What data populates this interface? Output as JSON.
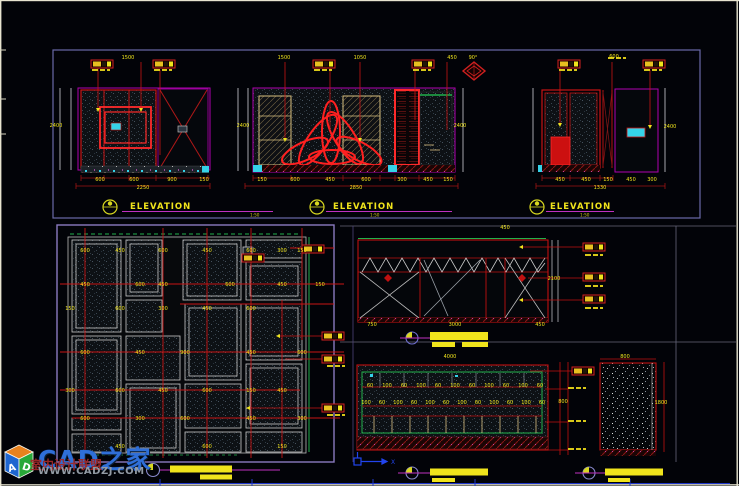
{
  "watermark": {
    "title": "CAD之家",
    "subtitle": "室内设计联盟",
    "url": "WWW.CADZJ.COM",
    "cube_left": "A",
    "cube_right": "D"
  },
  "titles": {
    "elevation": "ELEVATION",
    "scale": "1:50",
    "angle": "90°"
  },
  "colors": {
    "frame_red": "#c81414",
    "bright_red": "#ff2a2a",
    "magenta": "#b000b0",
    "yellow": "#f0e41c",
    "cyan": "#35d2e8",
    "green": "#22b14c",
    "section_border": "#6a6aa8",
    "plan_border": "#8a7ac0",
    "blue": "#2a4fd0"
  },
  "label_boxes": [
    {
      "x": 91,
      "y": 60
    },
    {
      "x": 153,
      "y": 60
    },
    {
      "x": 313,
      "y": 60
    },
    {
      "x": 412,
      "y": 60
    },
    {
      "x": 558,
      "y": 60
    },
    {
      "x": 643,
      "y": 60
    },
    {
      "x": 322,
      "y": 332
    },
    {
      "x": 322,
      "y": 355
    },
    {
      "x": 322,
      "y": 404
    },
    {
      "x": 583,
      "y": 243
    },
    {
      "x": 583,
      "y": 273
    },
    {
      "x": 583,
      "y": 295
    },
    {
      "x": 572,
      "y": 367
    },
    {
      "x": 302,
      "y": 245
    },
    {
      "x": 242,
      "y": 254
    }
  ],
  "dash_rows": [
    {
      "x": 92,
      "y": 69
    },
    {
      "x": 154,
      "y": 69
    },
    {
      "x": 314,
      "y": 69
    },
    {
      "x": 413,
      "y": 69
    },
    {
      "x": 559,
      "y": 69
    },
    {
      "x": 644,
      "y": 69
    },
    {
      "x": 608,
      "y": 57
    },
    {
      "x": 585,
      "y": 254
    },
    {
      "x": 585,
      "y": 285
    },
    {
      "x": 585,
      "y": 307
    },
    {
      "x": 568,
      "y": 387
    },
    {
      "x": 568,
      "y": 420
    },
    {
      "x": 568,
      "y": 448
    },
    {
      "x": 327,
      "y": 365
    },
    {
      "x": 327,
      "y": 414
    }
  ],
  "dim_labels": [
    {
      "x": 56,
      "y": 127,
      "t": "2400"
    },
    {
      "x": 128,
      "y": 59,
      "t": "1500"
    },
    {
      "x": 100,
      "y": 181,
      "t": "600"
    },
    {
      "x": 134,
      "y": 181,
      "t": "600"
    },
    {
      "x": 172,
      "y": 181,
      "t": "900"
    },
    {
      "x": 204,
      "y": 181,
      "t": "150"
    },
    {
      "x": 143,
      "y": 189,
      "t": "2250"
    },
    {
      "x": 243,
      "y": 127,
      "t": "2400"
    },
    {
      "x": 284,
      "y": 59,
      "t": "1500"
    },
    {
      "x": 360,
      "y": 59,
      "t": "1050"
    },
    {
      "x": 452,
      "y": 59,
      "t": "450"
    },
    {
      "x": 262,
      "y": 181,
      "t": "150"
    },
    {
      "x": 295,
      "y": 181,
      "t": "600"
    },
    {
      "x": 330,
      "y": 181,
      "t": "450"
    },
    {
      "x": 366,
      "y": 181,
      "t": "600"
    },
    {
      "x": 402,
      "y": 181,
      "t": "300"
    },
    {
      "x": 428,
      "y": 181,
      "t": "450"
    },
    {
      "x": 448,
      "y": 181,
      "t": "150"
    },
    {
      "x": 356,
      "y": 189,
      "t": "2850"
    },
    {
      "x": 460,
      "y": 127,
      "t": "2400"
    },
    {
      "x": 560,
      "y": 181,
      "t": "450"
    },
    {
      "x": 586,
      "y": 181,
      "t": "450"
    },
    {
      "x": 608,
      "y": 181,
      "t": "150"
    },
    {
      "x": 631,
      "y": 181,
      "t": "450"
    },
    {
      "x": 652,
      "y": 181,
      "t": "300"
    },
    {
      "x": 600,
      "y": 189,
      "t": "1330"
    },
    {
      "x": 670,
      "y": 128,
      "t": "2400"
    },
    {
      "x": 614,
      "y": 58,
      "t": "600"
    },
    {
      "x": 85,
      "y": 252,
      "t": "600"
    },
    {
      "x": 120,
      "y": 252,
      "t": "450"
    },
    {
      "x": 163,
      "y": 252,
      "t": "600"
    },
    {
      "x": 207,
      "y": 252,
      "t": "450"
    },
    {
      "x": 251,
      "y": 252,
      "t": "600"
    },
    {
      "x": 282,
      "y": 252,
      "t": "300"
    },
    {
      "x": 302,
      "y": 252,
      "t": "150"
    },
    {
      "x": 85,
      "y": 286,
      "t": "450"
    },
    {
      "x": 140,
      "y": 286,
      "t": "600"
    },
    {
      "x": 163,
      "y": 286,
      "t": "450"
    },
    {
      "x": 230,
      "y": 286,
      "t": "600"
    },
    {
      "x": 282,
      "y": 286,
      "t": "450"
    },
    {
      "x": 320,
      "y": 286,
      "t": "150"
    },
    {
      "x": 70,
      "y": 310,
      "t": "150"
    },
    {
      "x": 120,
      "y": 310,
      "t": "600"
    },
    {
      "x": 163,
      "y": 310,
      "t": "300"
    },
    {
      "x": 207,
      "y": 310,
      "t": "450"
    },
    {
      "x": 251,
      "y": 310,
      "t": "600"
    },
    {
      "x": 85,
      "y": 354,
      "t": "600"
    },
    {
      "x": 140,
      "y": 354,
      "t": "450"
    },
    {
      "x": 185,
      "y": 354,
      "t": "900"
    },
    {
      "x": 251,
      "y": 354,
      "t": "450"
    },
    {
      "x": 302,
      "y": 354,
      "t": "600"
    },
    {
      "x": 70,
      "y": 392,
      "t": "300"
    },
    {
      "x": 120,
      "y": 392,
      "t": "600"
    },
    {
      "x": 163,
      "y": 392,
      "t": "450"
    },
    {
      "x": 207,
      "y": 392,
      "t": "600"
    },
    {
      "x": 251,
      "y": 392,
      "t": "150"
    },
    {
      "x": 282,
      "y": 392,
      "t": "450"
    },
    {
      "x": 85,
      "y": 420,
      "t": "600"
    },
    {
      "x": 140,
      "y": 420,
      "t": "300"
    },
    {
      "x": 185,
      "y": 420,
      "t": "600"
    },
    {
      "x": 251,
      "y": 420,
      "t": "450"
    },
    {
      "x": 302,
      "y": 420,
      "t": "300"
    },
    {
      "x": 120,
      "y": 448,
      "t": "450"
    },
    {
      "x": 207,
      "y": 448,
      "t": "600"
    },
    {
      "x": 282,
      "y": 448,
      "t": "150"
    },
    {
      "x": 372,
      "y": 326,
      "t": "750"
    },
    {
      "x": 455,
      "y": 326,
      "t": "3000"
    },
    {
      "x": 540,
      "y": 326,
      "t": "450"
    },
    {
      "x": 554,
      "y": 280,
      "t": "2100"
    },
    {
      "x": 505,
      "y": 229,
      "t": "450"
    },
    {
      "x": 450,
      "y": 358,
      "t": "4000"
    },
    {
      "x": 563,
      "y": 403,
      "t": "800"
    },
    {
      "x": 625,
      "y": 358,
      "t": "800"
    },
    {
      "x": 661,
      "y": 404,
      "t": "1800"
    },
    {
      "x": 370,
      "y": 387,
      "t": "60"
    },
    {
      "x": 387,
      "y": 387,
      "t": "100"
    },
    {
      "x": 404,
      "y": 387,
      "t": "60"
    },
    {
      "x": 421,
      "y": 387,
      "t": "100"
    },
    {
      "x": 438,
      "y": 387,
      "t": "60"
    },
    {
      "x": 455,
      "y": 387,
      "t": "100"
    },
    {
      "x": 472,
      "y": 387,
      "t": "60"
    },
    {
      "x": 489,
      "y": 387,
      "t": "100"
    },
    {
      "x": 506,
      "y": 387,
      "t": "60"
    },
    {
      "x": 523,
      "y": 387,
      "t": "100"
    },
    {
      "x": 540,
      "y": 387,
      "t": "60"
    },
    {
      "x": 366,
      "y": 404,
      "t": "100"
    },
    {
      "x": 382,
      "y": 404,
      "t": "60"
    },
    {
      "x": 398,
      "y": 404,
      "t": "100"
    },
    {
      "x": 414,
      "y": 404,
      "t": "60"
    },
    {
      "x": 430,
      "y": 404,
      "t": "100"
    },
    {
      "x": 446,
      "y": 404,
      "t": "60"
    },
    {
      "x": 462,
      "y": 404,
      "t": "100"
    },
    {
      "x": 478,
      "y": 404,
      "t": "60"
    },
    {
      "x": 494,
      "y": 404,
      "t": "100"
    },
    {
      "x": 510,
      "y": 404,
      "t": "60"
    },
    {
      "x": 526,
      "y": 404,
      "t": "100"
    },
    {
      "x": 542,
      "y": 404,
      "t": "60"
    }
  ]
}
